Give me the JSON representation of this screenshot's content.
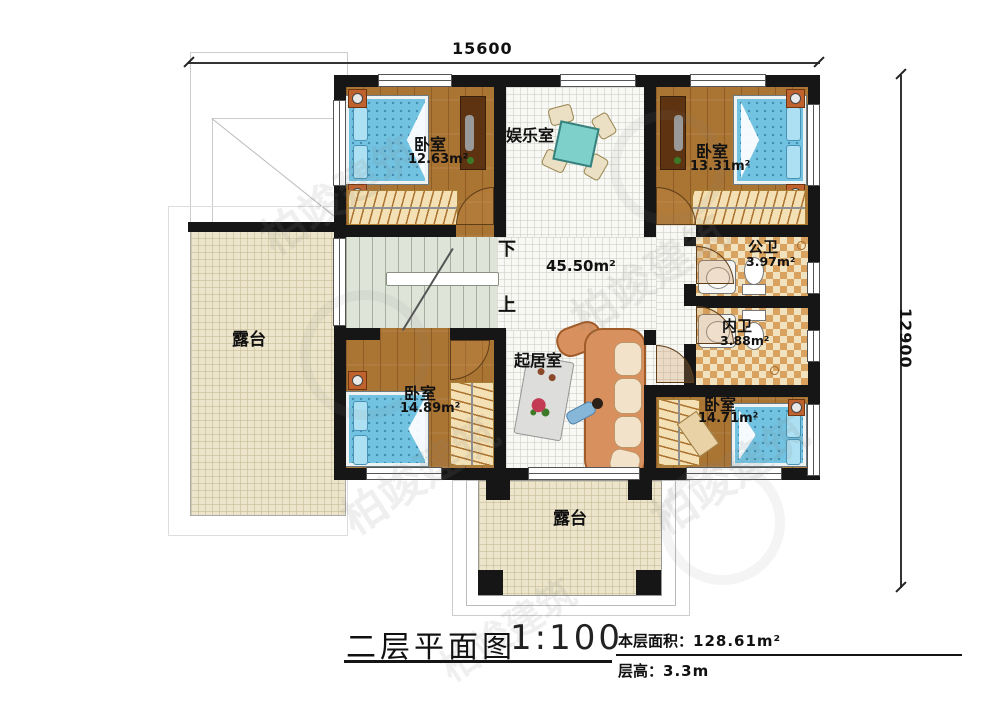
{
  "dimensions": {
    "top": "15600",
    "right": "12900"
  },
  "rooms": {
    "bedroom_tl": {
      "name": "卧室",
      "area": "12.63m²"
    },
    "entertainment_room": {
      "name": "娱乐室"
    },
    "bedroom_tr": {
      "name": "卧室",
      "area": "13.31m²"
    },
    "public_bathroom": {
      "name": "公卫",
      "area": "3.97m²"
    },
    "private_bathroom": {
      "name": "内卫",
      "area": "3.88m²"
    },
    "living_hall": {
      "name": "起居室",
      "area": "45.50m²"
    },
    "bedroom_bl": {
      "name": "卧室",
      "area": "14.89m²"
    },
    "bedroom_br": {
      "name": "卧室",
      "area": "14.71m²"
    },
    "terrace_left": {
      "name": "露台"
    },
    "terrace_bottom": {
      "name": "露台"
    }
  },
  "stairs": {
    "down_label": "下",
    "up_label": "上"
  },
  "title_block": {
    "title": "二层平面图",
    "scale": "1:100",
    "floor_area_label": "本层面积：",
    "floor_area_value": "128.61m²",
    "floor_height_label": "层高：",
    "floor_height_value": "3.3m"
  },
  "watermark": {
    "text": "柏竣建筑"
  },
  "colors": {
    "wall": "#161616",
    "wood_floor": "#aa7433",
    "tile_floor": "#f8f8f5",
    "terrace_floor": "#ece5cb",
    "bath_checker": "#d9a35f",
    "bed": "#72c3e1",
    "sofa": "#d8905e",
    "stairs": "#dfe4d9",
    "closet": "#f3e0b4",
    "table": "#7ed0cb"
  }
}
